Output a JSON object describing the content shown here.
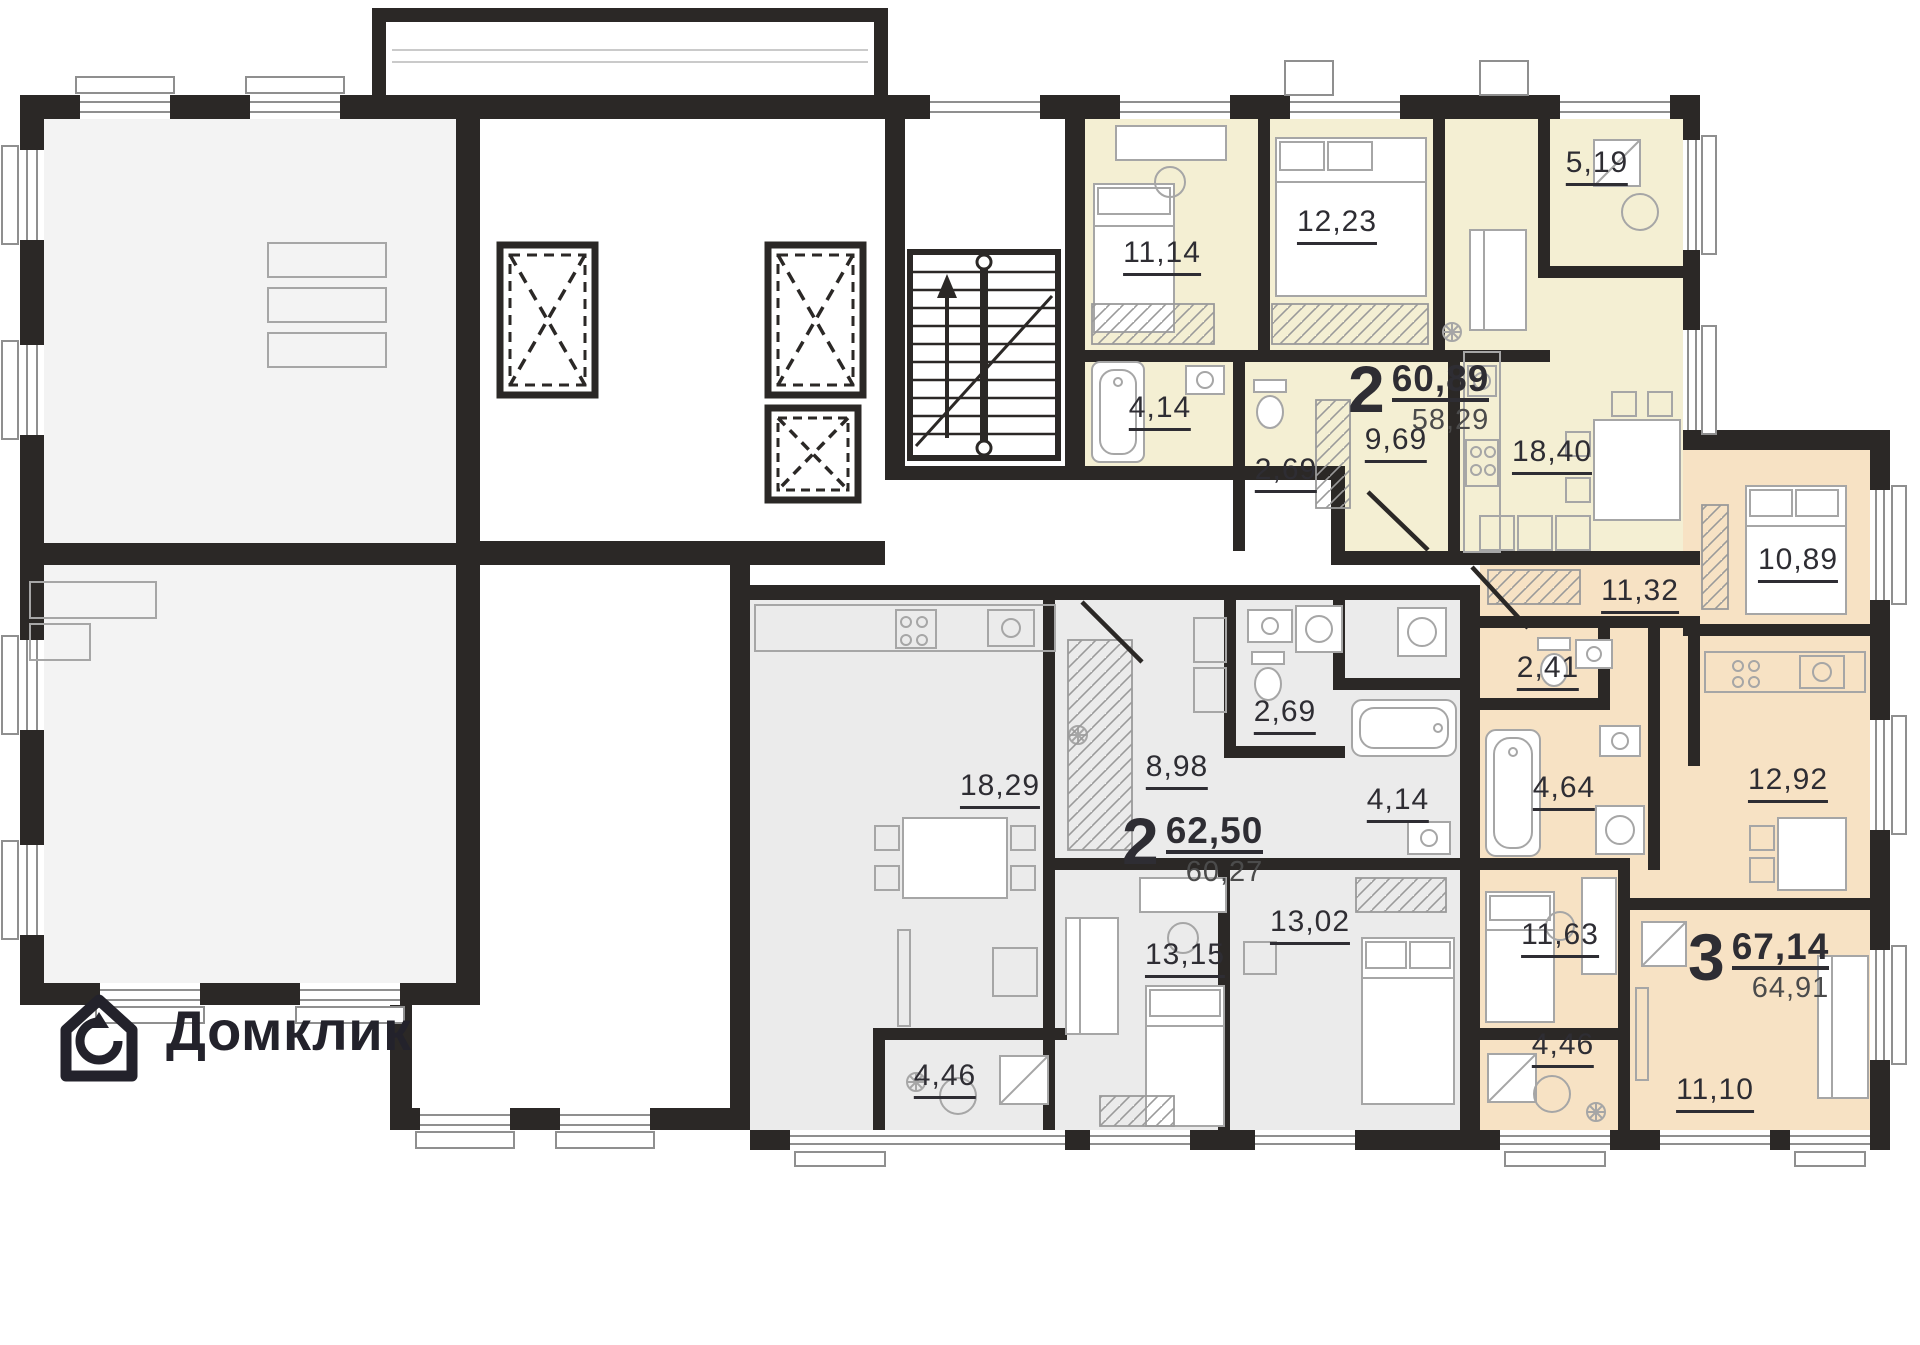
{
  "brand": {
    "name": "Домклик"
  },
  "floor_plan": {
    "apartments": [
      {
        "id": "apartment-2room-top",
        "rooms_count": "2",
        "total_area": "60,89",
        "living_area": "58,29",
        "rooms": [
          {
            "name": "bedroom",
            "area": "11,14"
          },
          {
            "name": "bedroom",
            "area": "12,23"
          },
          {
            "name": "balcony",
            "area": "5,19"
          },
          {
            "name": "bathroom",
            "area": "4,14"
          },
          {
            "name": "wc",
            "area": "2,69"
          },
          {
            "name": "hallway",
            "area": "9,69"
          },
          {
            "name": "kitchen-living",
            "area": "18,40"
          }
        ]
      },
      {
        "id": "apartment-2room-bottom",
        "rooms_count": "2",
        "total_area": "62,50",
        "living_area": "60,27",
        "rooms": [
          {
            "name": "kitchen-living",
            "area": "18,29"
          },
          {
            "name": "hallway",
            "area": "8,98"
          },
          {
            "name": "wc",
            "area": "2,69"
          },
          {
            "name": "bathroom",
            "area": "4,14"
          },
          {
            "name": "bedroom",
            "area": "13,15"
          },
          {
            "name": "bedroom",
            "area": "13,02"
          },
          {
            "name": "loggia",
            "area": "4,46"
          }
        ]
      },
      {
        "id": "apartment-3room-right",
        "rooms_count": "3",
        "total_area": "67,14",
        "living_area": "64,91",
        "rooms": [
          {
            "name": "hallway",
            "area": "11,32"
          },
          {
            "name": "bedroom",
            "area": "10,89"
          },
          {
            "name": "wc",
            "area": "2,41"
          },
          {
            "name": "bathroom",
            "area": "4,64"
          },
          {
            "name": "kitchen",
            "area": "12,92"
          },
          {
            "name": "bedroom",
            "area": "11,63"
          },
          {
            "name": "loggia",
            "area": "4,46"
          },
          {
            "name": "living-room",
            "area": "11,10"
          }
        ]
      }
    ],
    "colors": {
      "walls": "#2b2826",
      "apartment_top_fill": "#f4efd3",
      "apartment_bottom_fill": "#ebebeb",
      "apartment_right_fill": "#f7e2c4",
      "vacant_unit_fill": "#f3f3f3",
      "furniture_stroke": "#a6a6a6",
      "logo_color": "#23222b"
    }
  }
}
